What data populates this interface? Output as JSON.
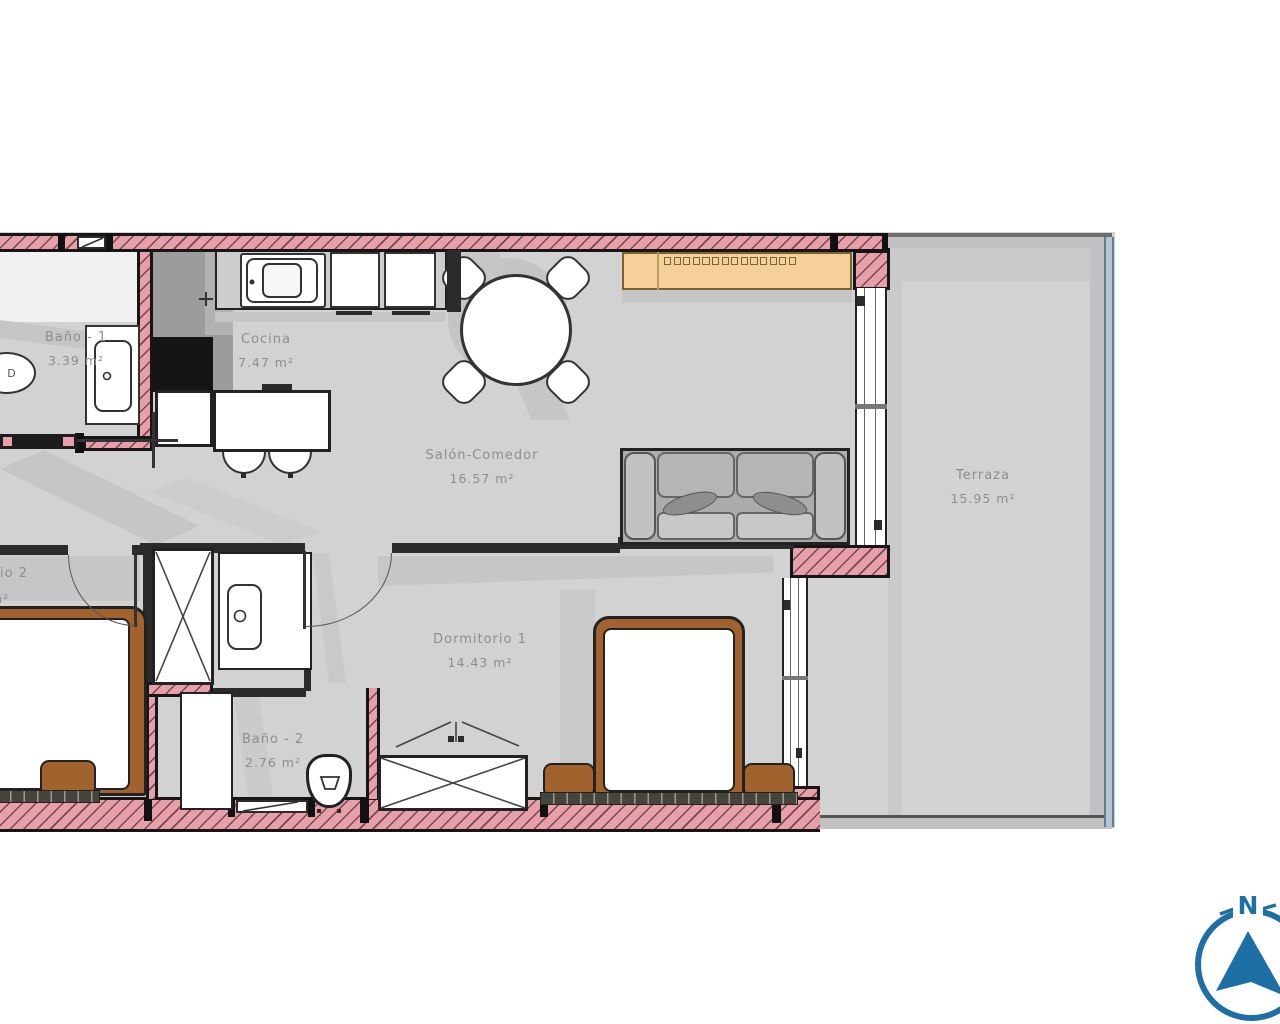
{
  "title": "apartment-floor-plan",
  "rooms": [
    {
      "name": "Baño - 1",
      "area": "3.39 m²"
    },
    {
      "name": "Cocina",
      "area": "7.47 m²"
    },
    {
      "name": "Salón-Comedor",
      "area": "16.57 m²"
    },
    {
      "name": "Terraza",
      "area": "15.95 m²"
    },
    {
      "name": "Dormitorio 1",
      "area": "14.43 m²"
    },
    {
      "name": "Baño - 2",
      "area": "2.76 m²"
    },
    {
      "name_fragment": "io 2",
      "area_fragment": "m²"
    }
  ],
  "fixtures": {
    "bidet_label": "D"
  },
  "compass": {
    "north_label": "N"
  },
  "colors": {
    "wall_pink": "#e7a0aa",
    "wall_dark": "#2b2b2b",
    "floor_gray": "#d2d2d2",
    "shadow_gray": "#c6c6c6",
    "wood_brown": "#a2622e",
    "sideboard_orange": "#f5d099",
    "railing_blue": "#5a7e9c",
    "compass_blue": "#1d6fa6"
  }
}
